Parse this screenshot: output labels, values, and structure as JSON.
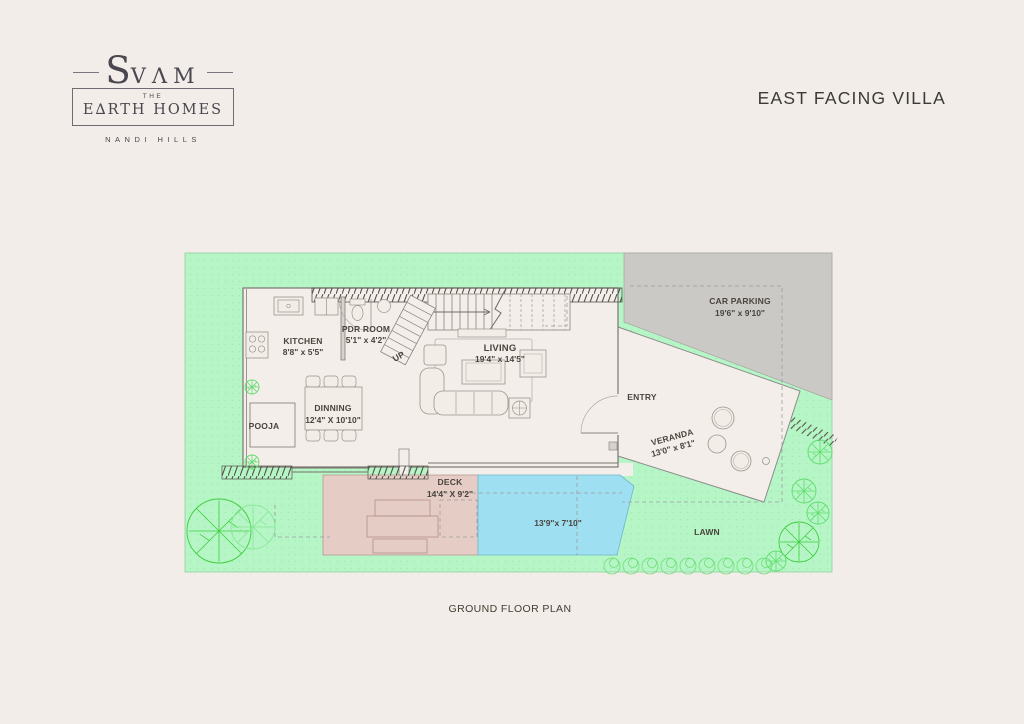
{
  "brand": {
    "s": "S",
    "vam": "VΛM",
    "the": "THE",
    "earth_homes": "E∆RTH HOMES",
    "location": "NANDI HILLS"
  },
  "header": {
    "title": "EAST FACING VILLA"
  },
  "footer": {
    "caption": "GROUND FLOOR PLAN"
  },
  "plan": {
    "labels": {
      "kitchen": {
        "name": "KITCHEN",
        "dim": "8'8\" x 5'5\""
      },
      "pdr_room": {
        "name": "PDR ROOM",
        "dim": "5'1\" x 4'2\""
      },
      "up": {
        "name": "UP"
      },
      "living": {
        "name": "LIVING",
        "dim": "19'4\" x 14'5\""
      },
      "dinning": {
        "name": "DINNING",
        "dim": "12'4\" X 10'10\""
      },
      "pooja": {
        "name": "POOJA"
      },
      "entry": {
        "name": "ENTRY"
      },
      "veranda": {
        "name": "VERANDA",
        "dim": "13'0\" x 8'1\""
      },
      "car_parking": {
        "name": "CAR PARKING",
        "dim": "19'6\" x 9'10\""
      },
      "deck": {
        "name": "DECK",
        "dim": "14'4\" X 9'2\""
      },
      "pool": {
        "dim": "13'9\"x 7'10\""
      },
      "lawn": {
        "name": "LAWN"
      }
    },
    "colors": {
      "background": "#f2ede8",
      "site_green": "#b6f5c5",
      "parking_gray": "#cac9c6",
      "house_fill": "#f3eee9",
      "pool_blue": "#9fdff2",
      "deck_pink": "#e5cdc6",
      "tree_green": "#3ecf3e"
    }
  }
}
